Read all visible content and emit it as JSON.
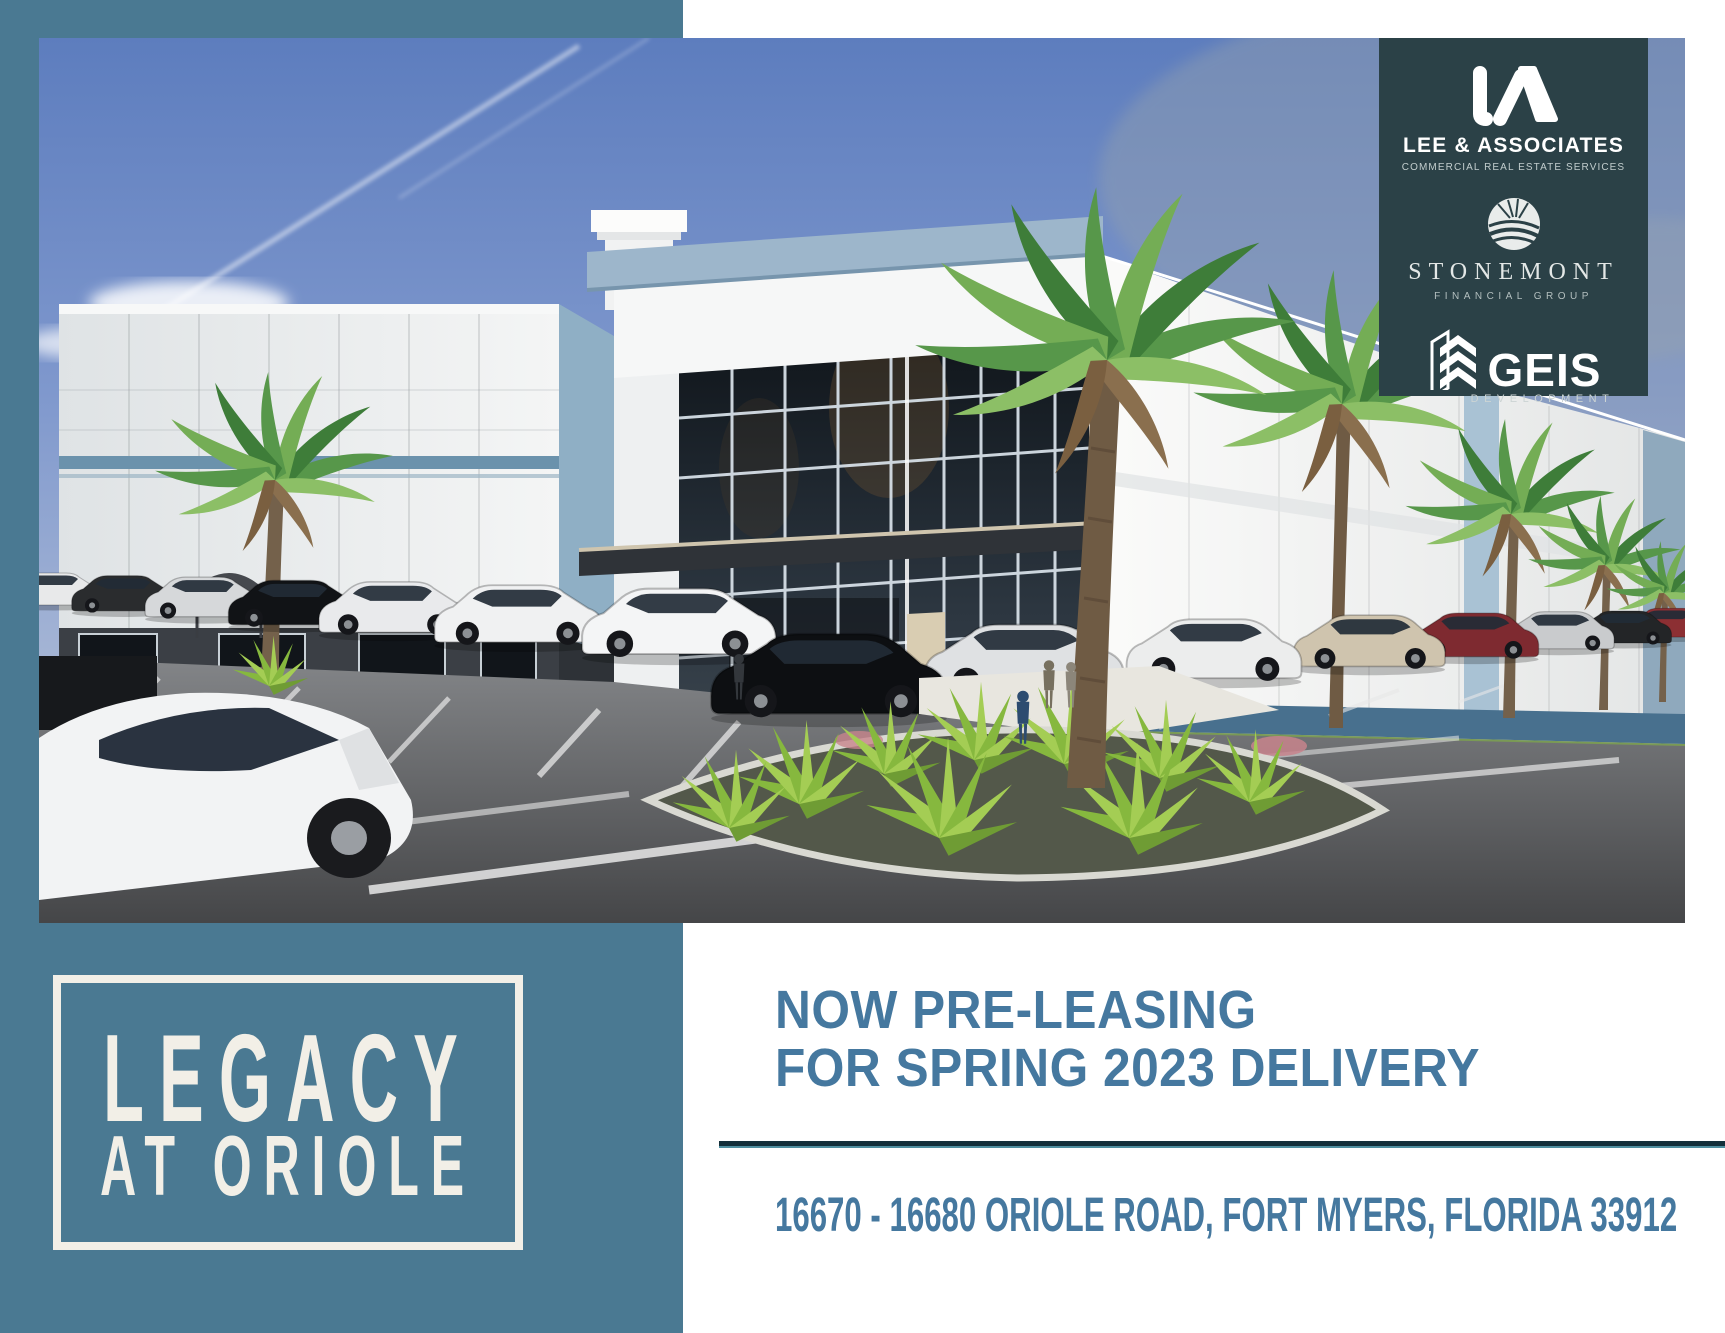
{
  "logos": {
    "lee": {
      "name": "LEE & ASSOCIATES",
      "tagline": "COMMERCIAL REAL ESTATE SERVICES"
    },
    "stonemont": {
      "name": "STONEMONT",
      "tagline": "FINANCIAL GROUP"
    },
    "geis": {
      "name": "GEIS",
      "tagline": "DEVELOPMENT"
    }
  },
  "project": {
    "title_line1": "LEGACY",
    "title_line2": "AT ORIOLE"
  },
  "promo": {
    "heading_line1": "NOW PRE-LEASING",
    "heading_line2": "FOR SPRING 2023 DELIVERY",
    "address": "16670 - 16680 ORIOLE ROAD, FORT MYERS, FLORIDA 33912"
  },
  "colors": {
    "teal_frame": "#4A7992",
    "logo_panel_bg": "#2B4147",
    "heading_text": "#45789F",
    "divider": "#14303B",
    "cream": "#F2EFE7",
    "sky_top": "#5D7DBE",
    "building_accent": "#6B92AC",
    "palm_green": "#57974A",
    "asphalt": "#4A4B4D"
  }
}
